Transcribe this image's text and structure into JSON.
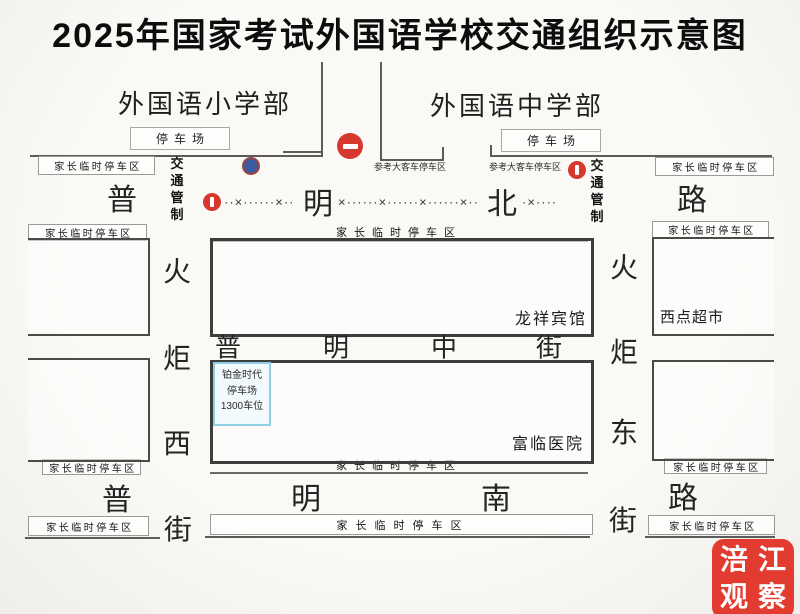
{
  "title": "2025年国家考试外国语学校交通组织示意图",
  "schools": {
    "primary": {
      "name": "外国语小学部",
      "parking": "停车场"
    },
    "secondary": {
      "name": "外国语中学部",
      "parking": "停车场"
    }
  },
  "roads": {
    "north": {
      "name": "普明北路",
      "chars": [
        "普",
        "明",
        "北",
        "路"
      ]
    },
    "middle": {
      "name": "普明中街",
      "chars": [
        "普",
        "明",
        "中",
        "街"
      ]
    },
    "south": {
      "name": "普明南路",
      "chars": [
        "普",
        "明",
        "南",
        "路"
      ]
    },
    "west": {
      "name": "火炬西街",
      "chars": [
        "火",
        "炬",
        "西",
        "街"
      ]
    },
    "east": {
      "name": "火炬东街",
      "chars": [
        "火",
        "炬",
        "东",
        "街"
      ]
    }
  },
  "labels": {
    "parent_parking": "家长临时停车区",
    "bus_parking": "参考大客车停车区",
    "traffic_control": "交通管制"
  },
  "pois": {
    "hotel": "龙祥宾馆",
    "bakery": "西点超市",
    "hospital": "富临医院",
    "parking_garage": {
      "line1": "铂金时代",
      "line2": "停车场",
      "line3": "1300车位"
    }
  },
  "closure": {
    "seg1": "··×······×··",
    "seg2": "×······×······×······×··",
    "seg3": "·×····"
  },
  "watermark": {
    "c1": "涪",
    "c2": "江",
    "c3": "观",
    "c4": "察"
  },
  "colors": {
    "sign_red": "#d6382e",
    "sign_blue": "#3d5a9e",
    "garage_border": "#92cfe6",
    "watermark_red": "#e23c31"
  }
}
